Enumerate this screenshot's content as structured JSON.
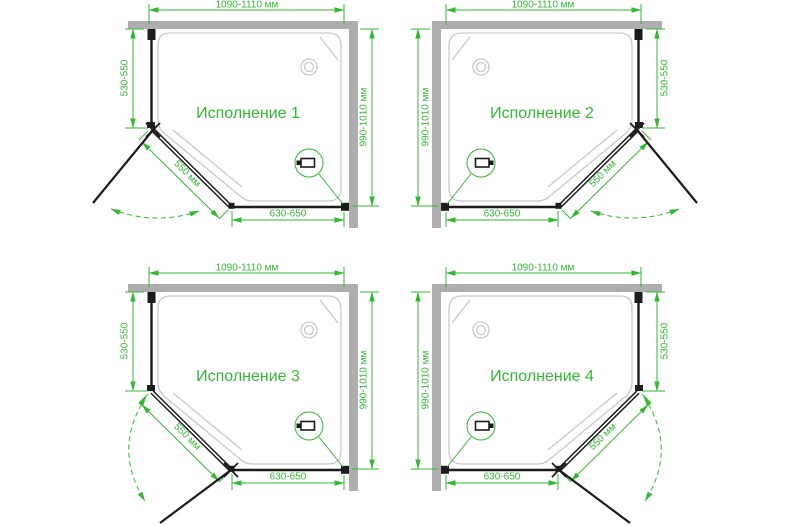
{
  "colors": {
    "green": "#33b833",
    "wall": "#aeaeae",
    "line": "#1c1c1c",
    "tray": "#c9c9c9",
    "bg": "#ffffff"
  },
  "variants": [
    {
      "title": "Исполнение 1",
      "dims": {
        "top": "1090-1110 мм",
        "left": "530-550",
        "right": "990-1010 мм",
        "door": "550 мм",
        "bottom": "630-650"
      }
    },
    {
      "title": "Исполнение 2",
      "dims": {
        "top": "1090-1110 мм",
        "left": "990-1010 мм",
        "right": "530-550",
        "door": "550 мм",
        "bottom": "630-650"
      }
    },
    {
      "title": "Исполнение 3",
      "dims": {
        "top": "1090-1110 мм",
        "left": "530-550",
        "right": "990-1010 мм",
        "door": "550 мм",
        "bottom": "630-650"
      }
    },
    {
      "title": "Исполнение 4",
      "dims": {
        "top": "1090-1110 мм",
        "left": "990-1010 мм",
        "right": "530-550",
        "door": "550 мм",
        "bottom": "630-650"
      }
    }
  ],
  "icons": {
    "drain": "drain-icon",
    "handle_detail": "handle-detail-icon",
    "door_hinge": "door-hinge-icon",
    "swing_arc": "door-swing-arc-icon"
  }
}
